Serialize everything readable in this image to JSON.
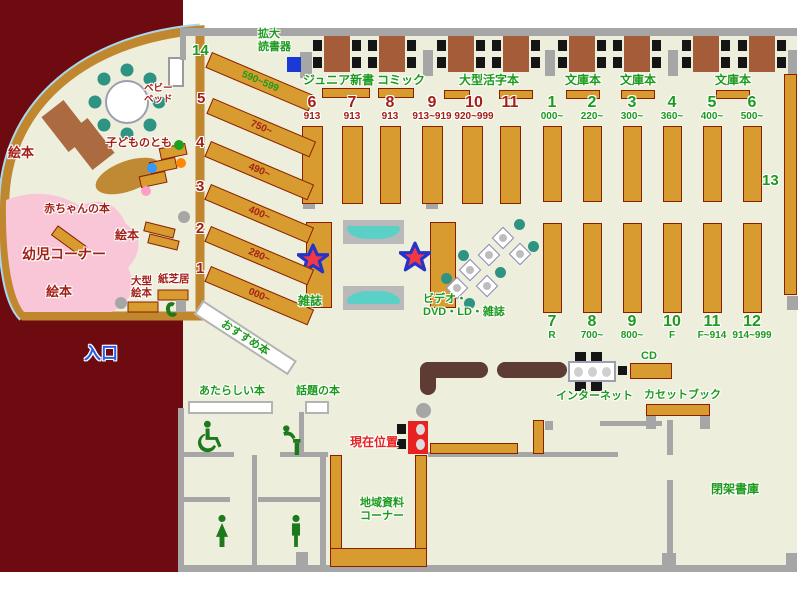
{
  "colors": {
    "exterior": "#6d0b11",
    "floor": "#eeeedd",
    "wall": "#a6a6a6",
    "shelf": "#d89b30",
    "shelf_border": "#8a2000",
    "table_wood": "#a55c39",
    "counter": "#5e3b33",
    "teal_seat": "#2e9382",
    "sofa_teal": "#5ad0c6",
    "kids_pink": "#f9c6d7",
    "green_text": "#1c9a1c",
    "dark_red_text": "#a32017",
    "location_red": "#e82222",
    "entrance_blue": "#2b5ce6",
    "reader_blue": "#1b39d5",
    "window_blue": "#a8d8f0",
    "wall_brown": "#c0872e"
  },
  "top_area": {
    "reader_line1": "拡大",
    "reader_line2": "読書器",
    "junior": "ジュニア新書",
    "comic": "コミック",
    "large_print": "大型活字本",
    "bunko_1": "文庫本",
    "bunko_2": "文庫本",
    "bunko_3": "文庫本"
  },
  "red_shelves": [
    {
      "num": "6",
      "range": "913"
    },
    {
      "num": "7",
      "range": "913"
    },
    {
      "num": "8",
      "range": "913"
    },
    {
      "num": "9",
      "range": "913~919"
    },
    {
      "num": "10",
      "range": "920~999"
    },
    {
      "num": "11",
      "range": ""
    }
  ],
  "green_top": [
    {
      "num": "1",
      "range": "000~"
    },
    {
      "num": "2",
      "range": "220~"
    },
    {
      "num": "3",
      "range": "300~"
    },
    {
      "num": "4",
      "range": "360~"
    },
    {
      "num": "5",
      "range": "400~"
    },
    {
      "num": "6",
      "range": "500~"
    }
  ],
  "green_bottom": [
    {
      "num": "7",
      "range": "R"
    },
    {
      "num": "8",
      "range": "700~"
    },
    {
      "num": "9",
      "range": "800~"
    },
    {
      "num": "10",
      "range": "F"
    },
    {
      "num": "11",
      "range": "F~914"
    },
    {
      "num": "12",
      "range": "914~999"
    }
  ],
  "shelf13": "13",
  "diagonal_shelves": [
    {
      "num": "14",
      "range": "590~599"
    },
    {
      "num": "5",
      "range": "750~"
    },
    {
      "num": "4",
      "range": "490~"
    },
    {
      "num": "3",
      "range": "400~"
    },
    {
      "num": "2",
      "range": "280~"
    },
    {
      "num": "1",
      "range": "000~"
    }
  ],
  "kids_area": {
    "ehon_top": "絵本",
    "kodomo_no_tomo": "子どものとも",
    "akachan": "赤ちゃんの本",
    "yoji_corner": "幼児コーナー",
    "ehon_mid": "絵本",
    "ehon_bottom": "絵本",
    "baby_bed_line1": "ベビー",
    "baby_bed_line2": "ベッド",
    "ogata_line1": "大型",
    "ogata_line2": "絵本",
    "kamishibai": "紙芝居",
    "osusume": "おすすめ本"
  },
  "center_area": {
    "zasshi": "雑誌",
    "video_line1": "ビデオ・",
    "video_line2": "DVD・LD・雑誌"
  },
  "bottom_area": {
    "entrance": "入口",
    "new_books": "あたらしい本",
    "topic_books": "話題の本",
    "current_location": "現在位置",
    "internet": "インターネット",
    "cd": "CD",
    "cassette": "カセットブック",
    "local_line1": "地域資料",
    "local_line2": "コーナー",
    "closed_stacks": "閉架書庫"
  }
}
